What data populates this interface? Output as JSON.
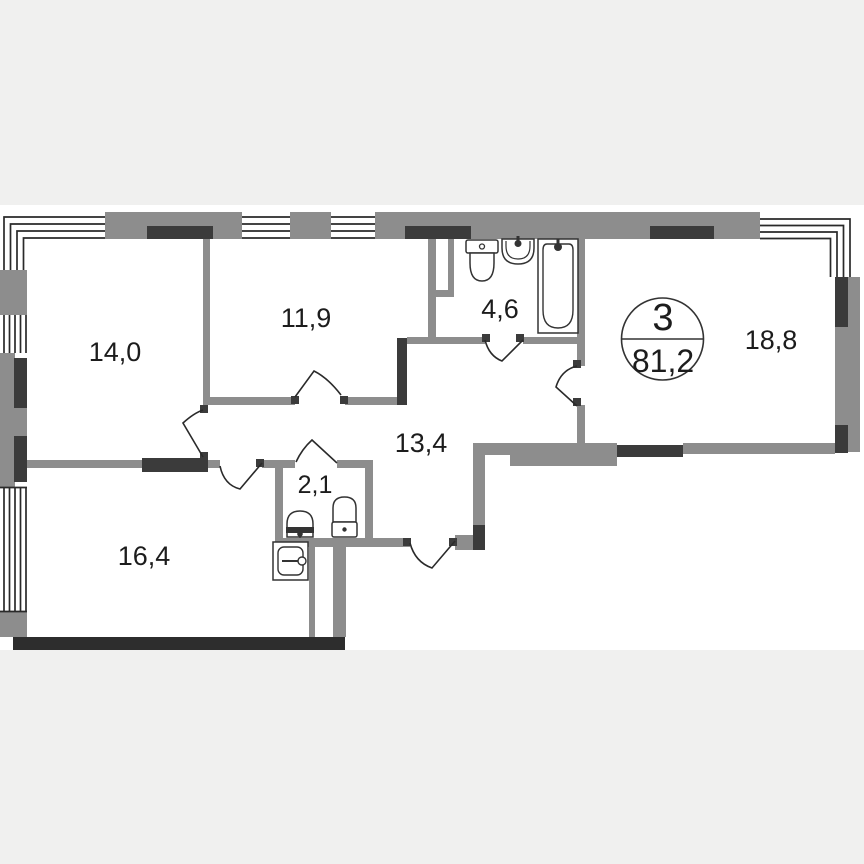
{
  "floorplan": {
    "badge": {
      "rooms_count": "3",
      "total_area": "81,2"
    },
    "rooms": [
      {
        "name": "bedroom-1",
        "area_label": "14,0"
      },
      {
        "name": "bedroom-2",
        "area_label": "11,9"
      },
      {
        "name": "bathroom",
        "area_label": "4,6"
      },
      {
        "name": "living-room",
        "area_label": "18,8"
      },
      {
        "name": "hallway",
        "area_label": "13,4"
      },
      {
        "name": "wc",
        "area_label": "2,1"
      },
      {
        "name": "kitchen-living-room",
        "area_label": "16,4"
      }
    ],
    "fixtures": [
      "toilet",
      "wash-basin",
      "bathtub",
      "wc-basin",
      "wc-toilet",
      "kitchen-sink"
    ],
    "colors": {
      "background": "#f0f0ef",
      "sheet": "#ffffff",
      "wall": "#8d8d8d",
      "wall_dark": "#3b3b3b",
      "wall_black": "#2d2d2d",
      "line": "#2a2a2a",
      "text": "#1c1c1c"
    }
  }
}
